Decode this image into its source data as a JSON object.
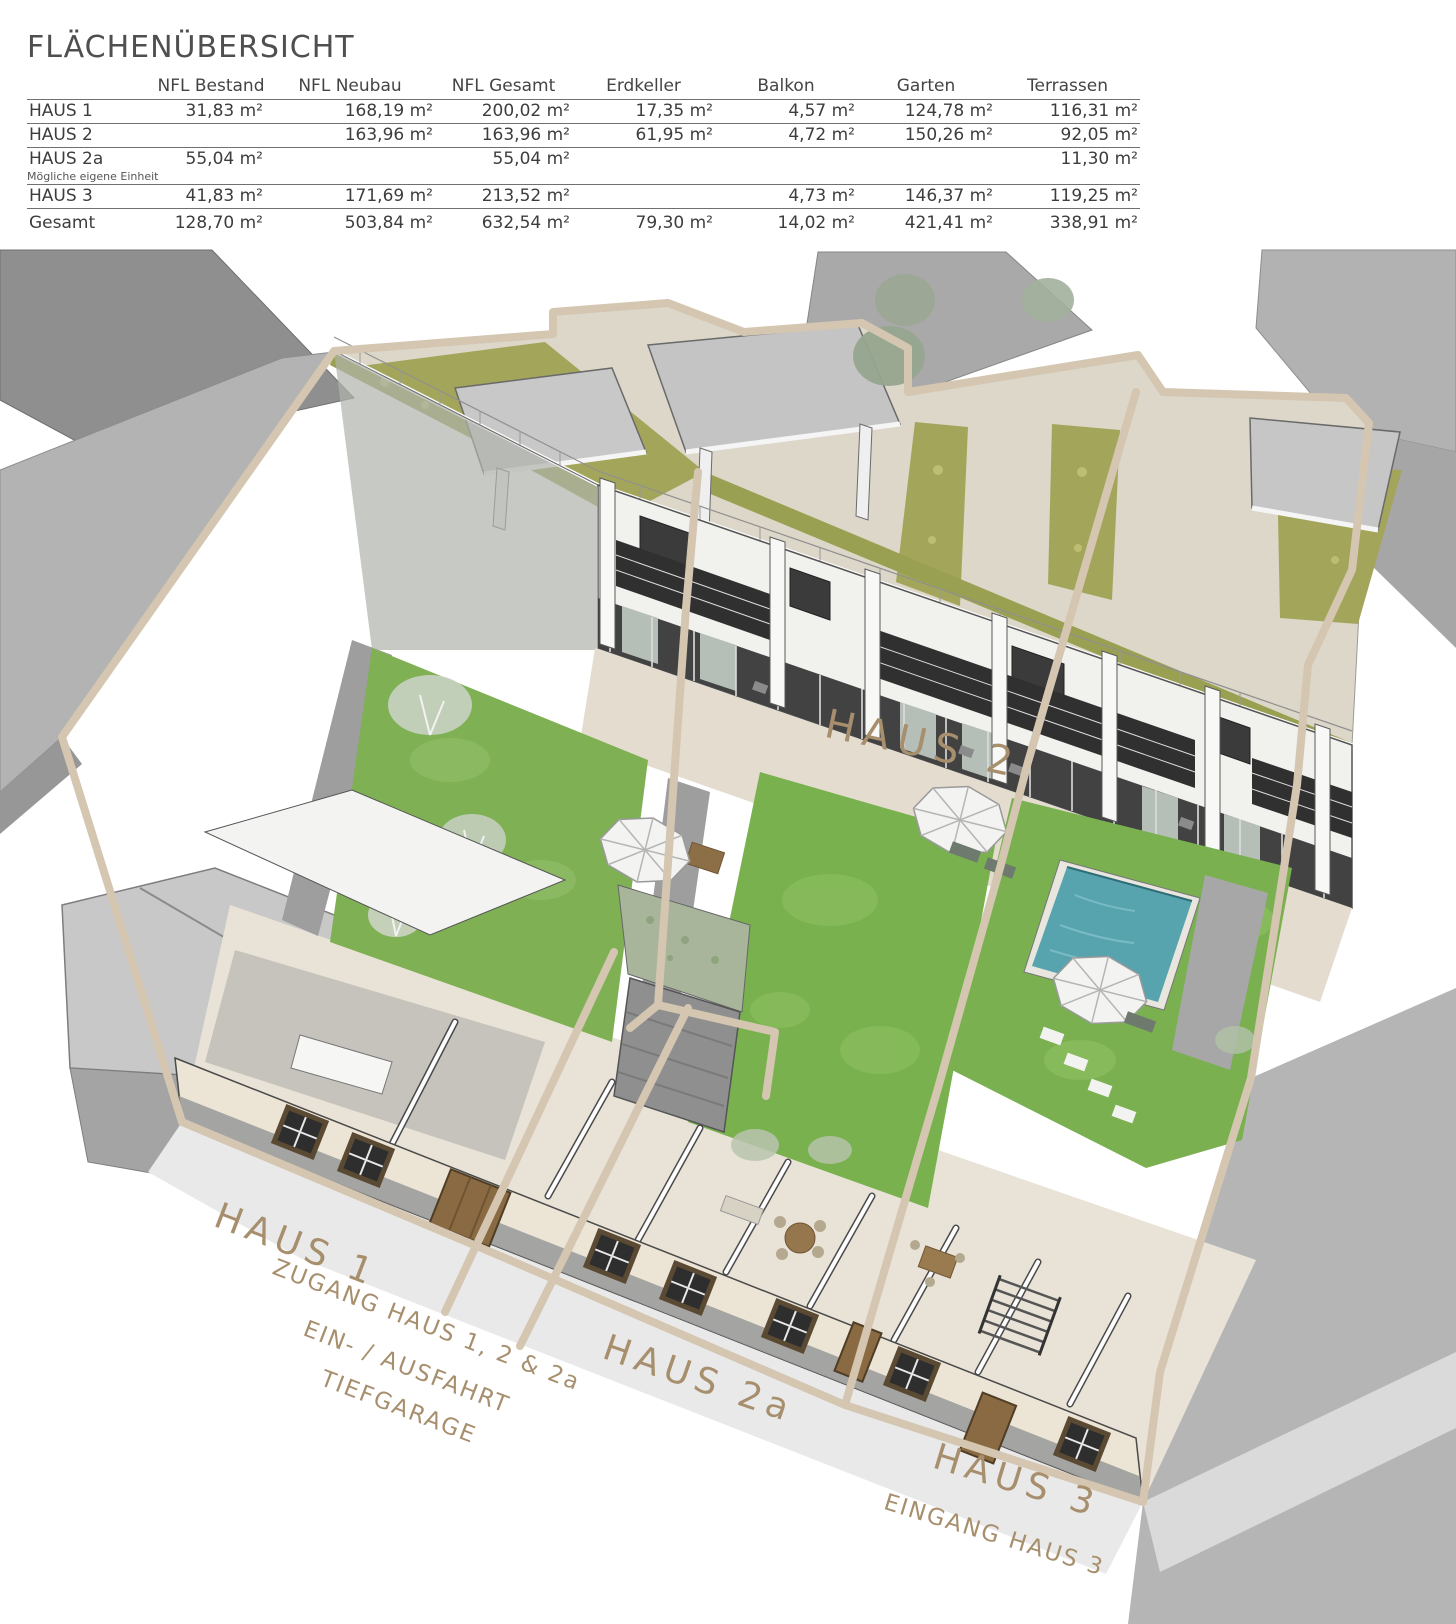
{
  "title": "FLÄCHENÜBERSICHT",
  "table": {
    "columns": [
      "NFL Bestand",
      "NFL Neubau",
      "NFL Gesamt",
      "Erdkeller",
      "Balkon",
      "Garten",
      "Terrassen"
    ],
    "rows": [
      {
        "name": "HAUS 1",
        "values": [
          "31,83 m²",
          "168,19 m²",
          "200,02 m²",
          "17,35 m²",
          "4,57 m²",
          "124,78 m²",
          "116,31 m²"
        ]
      },
      {
        "name": "HAUS 2",
        "values": [
          "",
          "163,96 m²",
          "163,96 m²",
          "61,95 m²",
          "4,72 m²",
          "150,26 m²",
          "92,05 m²"
        ]
      },
      {
        "name": "HAUS 2a",
        "note": "Mögliche eigene Einheit",
        "values": [
          "55,04 m²",
          "",
          "55,04 m²",
          "",
          "",
          "",
          "11,30 m²"
        ]
      },
      {
        "name": "HAUS 3",
        "values": [
          "41,83 m²",
          "171,69 m²",
          "213,52 m²",
          "",
          "4,73 m²",
          "146,37 m²",
          "119,25 m²"
        ]
      },
      {
        "name": "Gesamt",
        "values": [
          "128,70 m²",
          "503,84 m²",
          "632,54 m²",
          "79,30 m²",
          "14,02 m²",
          "421,41 m²",
          "338,91 m²"
        ]
      }
    ]
  },
  "site_plan": {
    "labels": {
      "haus1": "HAUS 1",
      "haus2": "HAUS 2",
      "haus2a": "HAUS 2a",
      "haus3": "HAUS 3",
      "zugang": "ZUGANG HAUS 1, 2 & 2a",
      "ein_ausfahrt": "EIN- / AUSFAHRT",
      "tiefgarage": "TIEFGARAGE",
      "eingang_haus3": "EINGANG HAUS 3"
    },
    "colors": {
      "parcel_line": "#d4c6b0",
      "label_text": "#a78f6e",
      "lawn_green": "#79b14f",
      "green_roof": "#a3a65a",
      "pool_water": "#57a3ae",
      "facade_cream": "#ece5d6",
      "neighbor_gray": "#b3b3b3"
    }
  }
}
